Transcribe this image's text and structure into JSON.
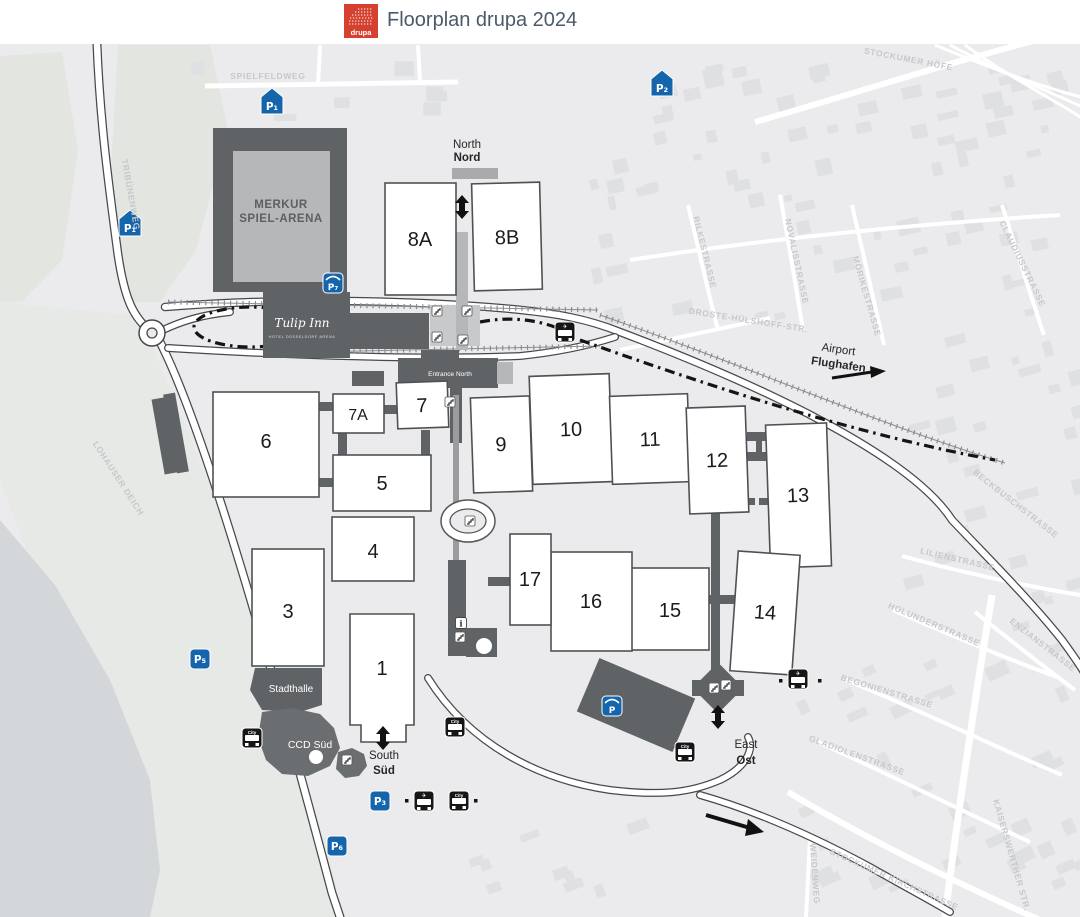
{
  "header": {
    "logo_text": "drupa",
    "title": "Floorplan drupa 2024"
  },
  "map": {
    "halls": [
      {
        "label": "1"
      },
      {
        "label": "3"
      },
      {
        "label": "4"
      },
      {
        "label": "5"
      },
      {
        "label": "6"
      },
      {
        "label": "7"
      },
      {
        "label": "7A"
      },
      {
        "label": "8A"
      },
      {
        "label": "8B"
      },
      {
        "label": "9"
      },
      {
        "label": "10"
      },
      {
        "label": "11"
      },
      {
        "label": "12"
      },
      {
        "label": "13"
      },
      {
        "label": "14"
      },
      {
        "label": "15"
      },
      {
        "label": "16"
      },
      {
        "label": "17"
      }
    ],
    "places": {
      "arena_line1": "MERKUR",
      "arena_line2": "SPIEL-ARENA",
      "hotel_name": "Tulip Inn",
      "hotel_sub": "HOTEL DÜSSELDORF ARENA",
      "stadthalle": "Stadthalle",
      "ccd_sued": "CCD Süd",
      "entrance_north": "Entrance North"
    },
    "entrances": {
      "north_en": "North",
      "north_de": "Nord",
      "south_en": "South",
      "south_de": "Süd",
      "east_en": "East",
      "east_de": "Ost"
    },
    "airport": {
      "en": "Airport",
      "de": "Flughafen"
    },
    "parking": [
      {
        "label": "P₁"
      },
      {
        "label": "P₁"
      },
      {
        "label": "P₂"
      },
      {
        "label": "P₇"
      },
      {
        "label": "P₅"
      },
      {
        "label": "P₃"
      },
      {
        "label": "P₆"
      },
      {
        "label": "P"
      }
    ],
    "streets": [
      "SPIELFELDWEG",
      "TRIBÜNENWEG",
      "LOHAUSER DEICH",
      "STOCKUMER HÖFE",
      "RILKESTRASSE",
      "NOVALISSTRASSE",
      "MÖRIKESTRASSE",
      "CLAUDIUSSTRASSE",
      "DROSTE-HÜLSHOFF-STR.",
      "BECKBUSCHSTRASSE",
      "LILIENSTRASSE",
      "HOLUNDERSTRASSE",
      "ENZIANSTRASSE",
      "BEGONIENSTRASSE",
      "GLADIOLENSTRASSE",
      "STOCKUMER KIRCHSTRASSE",
      "KAISERSWERTHER STR.",
      "WEIDENWEG"
    ],
    "icons": {
      "bus_city": "City",
      "bus_airport": "✈",
      "info": "i"
    }
  },
  "colors": {
    "accent_red": "#d6402e",
    "parking_blue": "#1565ad",
    "dark_building": "#606366",
    "hall_stroke": "#4f5254",
    "map_bg": "#ebebed"
  }
}
